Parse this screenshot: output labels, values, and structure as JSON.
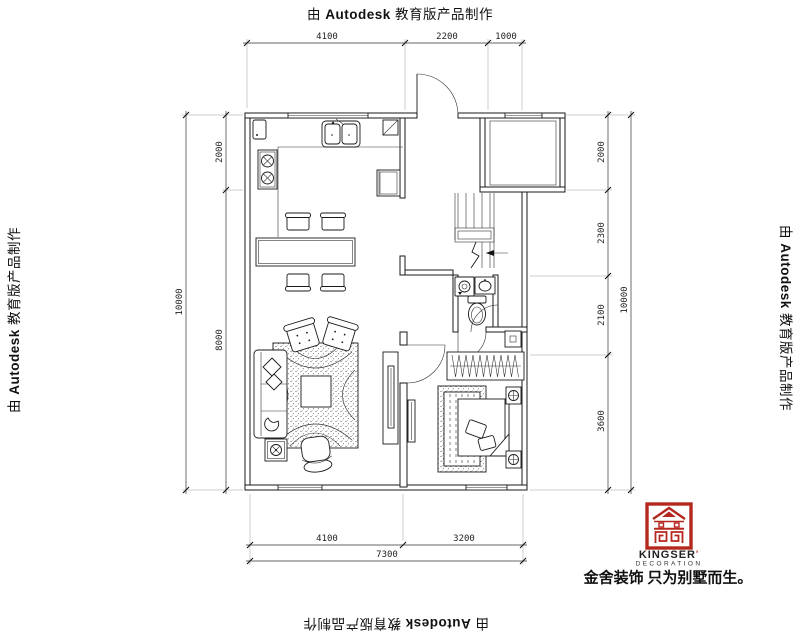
{
  "watermark": {
    "prefix": "由 ",
    "brand": "Autodesk",
    "suffix": " 教育版产品制作"
  },
  "dimensions": {
    "top": [
      "4100",
      "2200",
      "1000"
    ],
    "bottom_inner": [
      "4100",
      "3200"
    ],
    "bottom_total": "7300",
    "left_inner": [
      "2000",
      "8000"
    ],
    "left_total": "10000",
    "right_inner": [
      "2000",
      "2300",
      "2100",
      "3600"
    ],
    "right_total": "10000"
  },
  "logo": {
    "brand": "KINGSER",
    "mark": "'",
    "subtitle": "DECORATION",
    "tagline": "金舍装饰 只为别墅而生。",
    "accent_color": "#b5281e"
  },
  "plan": {
    "line_color": "#1a1a1a",
    "symbols": [
      "kitchen-sink",
      "stove",
      "fridge",
      "dining-table",
      "dining-chairs",
      "sofa",
      "armchairs",
      "coffee-table",
      "area-rug",
      "lounge-chair",
      "floor-lamp",
      "tv-cabinet",
      "stairs",
      "entry-door",
      "bathroom-toilet",
      "bathroom-vanity",
      "washing-machine",
      "bedroom-bed",
      "nightstands",
      "wardrobe",
      "windows"
    ]
  }
}
